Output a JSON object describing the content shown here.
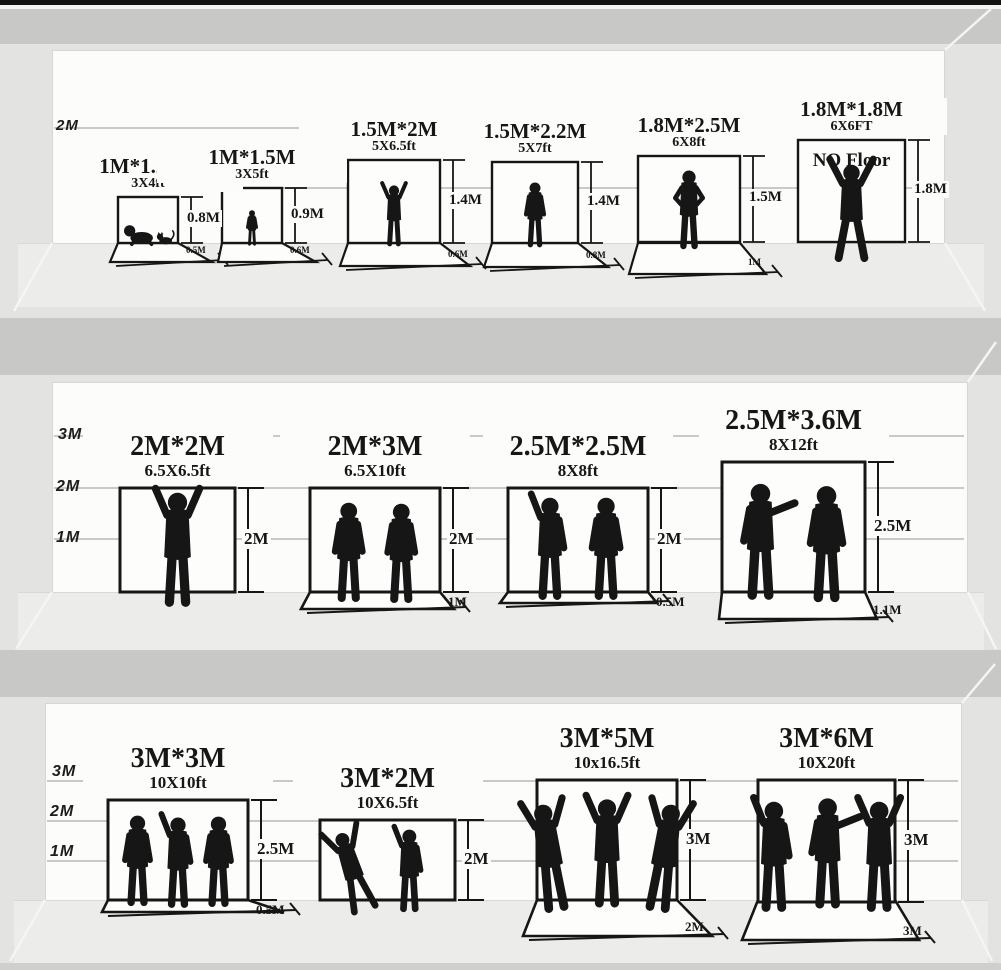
{
  "colors": {
    "ink": "#161616",
    "wall": "#fcfcfb",
    "floor": "#ececea",
    "side_wall": "#e3e3e1",
    "divider_band": "#c8c8c7",
    "top_border": "#141414",
    "gridline": "#c9c9c7"
  },
  "rows": [
    {
      "name": "small-backdrops",
      "scale": [
        "2M",
        "1M"
      ],
      "items": [
        {
          "size": "1M*1.25M",
          "ft": "3X4ft",
          "height": "0.8M",
          "floor": "0.5M",
          "figure": "baby-with-cat"
        },
        {
          "size": "1M*1.5M",
          "ft": "3X5ft",
          "height": "0.9M",
          "floor": "0.6M",
          "figure": "toddler"
        },
        {
          "size": "1.5M*2M",
          "ft": "5X6.5ft",
          "height": "1.4M",
          "floor": "0.6M",
          "figure": "child-arms-raised"
        },
        {
          "size": "1.5M*2.2M",
          "ft": "5X7ft",
          "height": "1.4M",
          "floor": "0.8M",
          "figure": "boy-standing"
        },
        {
          "size": "1.8M*2.5M",
          "ft": "6X8ft",
          "height": "1.5M",
          "floor": "1M",
          "figure": "man-hands-on-hips"
        },
        {
          "size": "1.8M*1.8M",
          "ft": "6X6FT",
          "height": "1.8M",
          "floor": "",
          "note": "NO Floor",
          "figure": "man-arms-legs-spread"
        }
      ]
    },
    {
      "name": "medium-backdrops",
      "scale": [
        "3M",
        "2M",
        "1M"
      ],
      "items": [
        {
          "size": "2M*2M",
          "ft": "6.5X6.5ft",
          "height": "2M",
          "floor": "",
          "figure": "man-victory-pose"
        },
        {
          "size": "2M*3M",
          "ft": "6.5X10ft",
          "height": "2M",
          "floor": "1M",
          "figure": "two-men-standing"
        },
        {
          "size": "2.5M*2.5M",
          "ft": "8X8ft",
          "height": "2M",
          "floor": "0.5M",
          "figure": "two-men-talking"
        },
        {
          "size": "2.5M*3.6M",
          "ft": "8X12ft",
          "height": "2.5M",
          "floor": "1.1M",
          "figure": "two-men-pointing"
        }
      ]
    },
    {
      "name": "large-backdrops",
      "scale": [
        "3M",
        "2M",
        "1M"
      ],
      "items": [
        {
          "size": "3M*3M",
          "ft": "10X10ft",
          "height": "2.5M",
          "floor": "0.5M",
          "figure": "three-people-group"
        },
        {
          "size": "3M*2M",
          "ft": "10X6.5ft",
          "height": "2M",
          "floor": "",
          "figure": "two-dancers"
        },
        {
          "size": "3M*5M",
          "ft": "10x16.5ft",
          "height": "3M",
          "floor": "2M",
          "figure": "three-dancers-jumping"
        },
        {
          "size": "3M*6M",
          "ft": "10X20ft",
          "height": "3M",
          "floor": "3M",
          "figure": "three-musicians"
        }
      ]
    }
  ]
}
